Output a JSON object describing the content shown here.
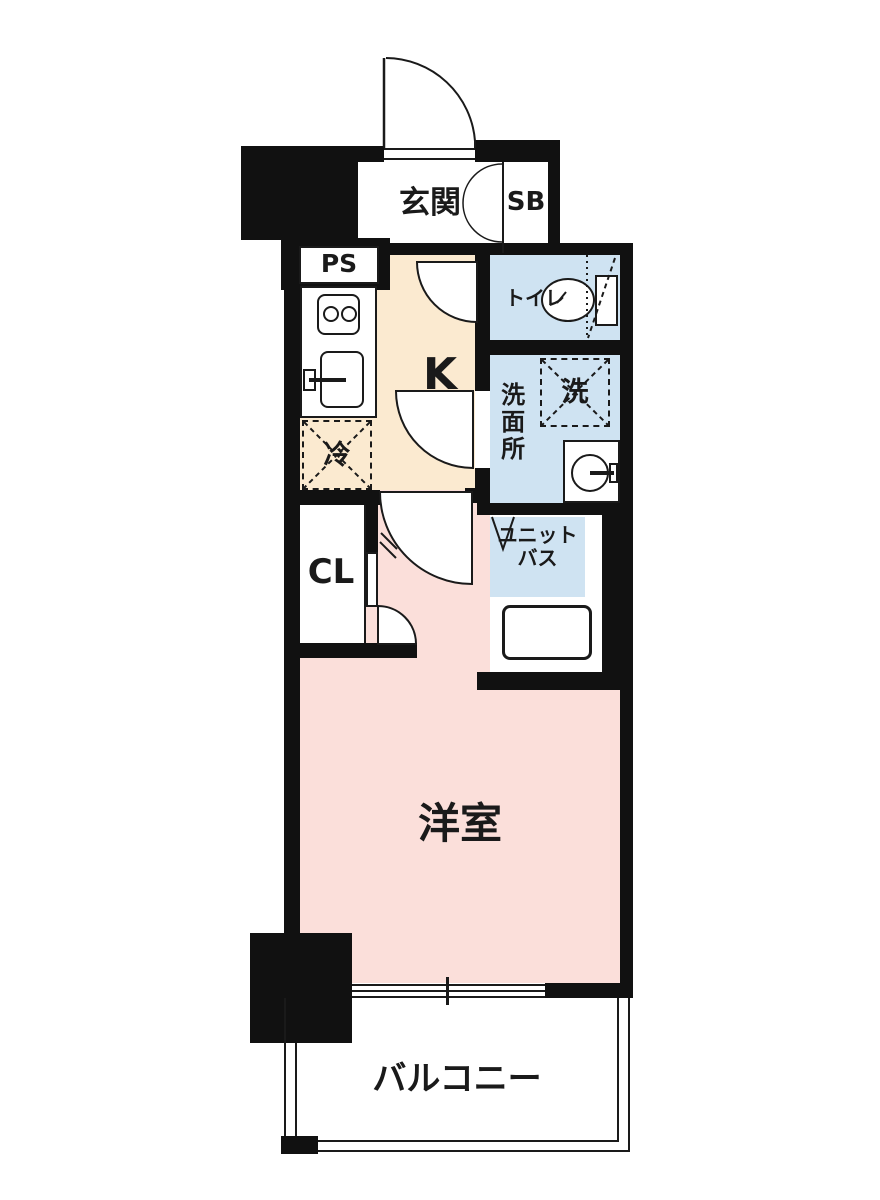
{
  "floorplan": {
    "labels": {
      "entrance": "玄関",
      "shoe_box": "SB",
      "pipe_space": "PS",
      "kitchen": "K",
      "toilet": "トイレ",
      "washroom": "洗面所",
      "washing_machine": "洗",
      "refrigerator": "冷",
      "closet": "CL",
      "unit_bath_line1": "ユニット",
      "unit_bath_line2": "バス",
      "western_room": "洋室",
      "balcony": "バルコニー"
    },
    "colors": {
      "wall": "#111111",
      "line": "#1a1a1a",
      "kitchen_floor": "#fbead0",
      "room_floor": "#fbdfda",
      "wet_area_floor": "#cfe3f2",
      "background": "#ffffff"
    }
  }
}
